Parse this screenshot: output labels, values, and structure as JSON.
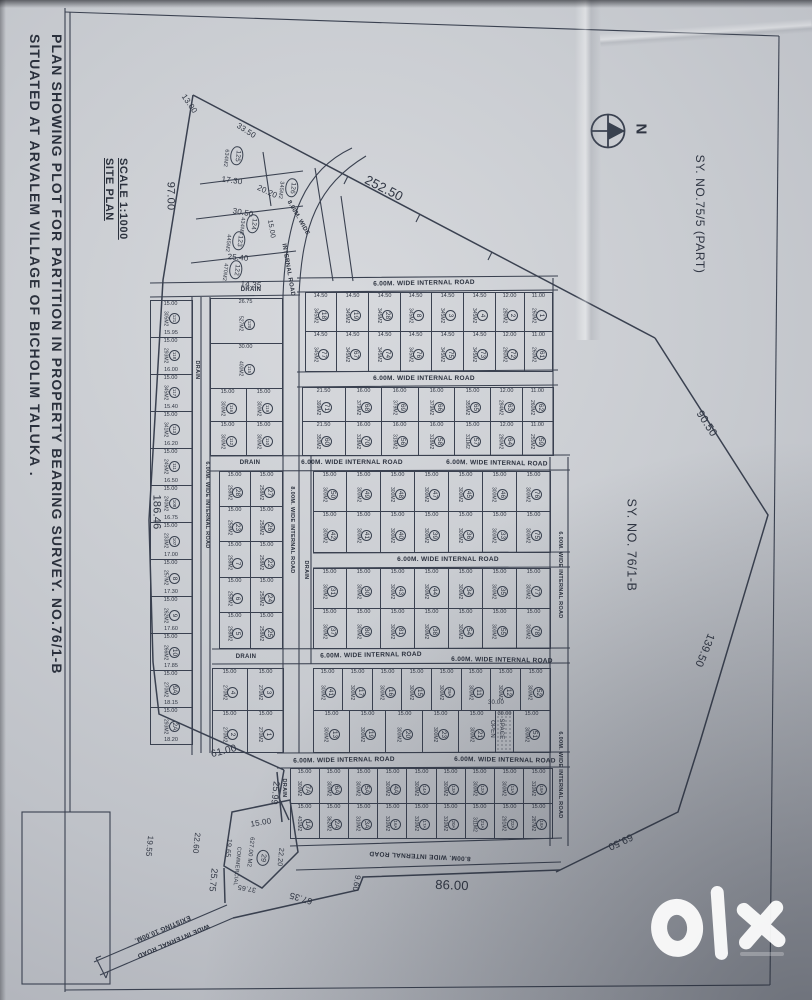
{
  "header": {
    "title_line1": "PLAN SHOWING PLOT FOR PARTITION IN PROPERTY BEARING SURVEY. NO.76/1-B",
    "title_line2": "SITUATED AT ARVALEM VILLAGE OF BICHOLIM TALUKA ."
  },
  "site_plan": {
    "label": "SITE PLAN",
    "scale": "SCALE 1:1000"
  },
  "survey": {
    "part_75": "SY. NO.75/5 (PART)",
    "main_76": "SY. NO. 76/1-B"
  },
  "compass": {
    "north": "N"
  },
  "watermark": {
    "brand": "olx"
  },
  "ink_color": "#323947",
  "paper_color": "#c9ccd1",
  "boundary_dimensions": [
    {
      "t": "97.00",
      "x": 170,
      "y": 196,
      "r": 90,
      "s": 11
    },
    {
      "t": "252.50",
      "x": 384,
      "y": 188,
      "r": 27,
      "s": 13
    },
    {
      "t": "90.50",
      "x": 706,
      "y": 424,
      "r": 57,
      "s": 11
    },
    {
      "t": "139.50",
      "x": 704,
      "y": 650,
      "r": 112,
      "s": 11
    },
    {
      "t": "69.50",
      "x": 620,
      "y": 841,
      "r": 155,
      "s": 10
    },
    {
      "t": "86.00",
      "x": 452,
      "y": 885,
      "r": 2,
      "s": 13
    },
    {
      "t": "67.35",
      "x": 301,
      "y": 898,
      "r": 197,
      "s": 9
    },
    {
      "t": "9.60",
      "x": 356,
      "y": 883,
      "r": 100,
      "s": 8
    },
    {
      "t": "186.46",
      "x": 156,
      "y": 512,
      "r": 90,
      "s": 11
    },
    {
      "t": "61.00",
      "x": 224,
      "y": 752,
      "r": -14,
      "s": 10
    },
    {
      "t": "25.99",
      "x": 275,
      "y": 793,
      "r": 96,
      "s": 9
    },
    {
      "t": "25.75",
      "x": 213,
      "y": 880,
      "r": 96,
      "s": 9
    },
    {
      "t": "19.55",
      "x": 149,
      "y": 846,
      "r": 96,
      "s": 8
    },
    {
      "t": "22.60",
      "x": 196,
      "y": 843,
      "r": 96,
      "s": 8
    },
    {
      "t": "13.00",
      "x": 189,
      "y": 104,
      "r": 55,
      "s": 8
    },
    {
      "t": "33.50",
      "x": 246,
      "y": 131,
      "r": 33,
      "s": 8
    },
    {
      "t": "17.30",
      "x": 232,
      "y": 181,
      "r": 8,
      "s": 8
    },
    {
      "t": "30.50",
      "x": 243,
      "y": 213,
      "r": 10,
      "s": 8
    },
    {
      "t": "20.20",
      "x": 267,
      "y": 192,
      "r": 25,
      "s": 8
    },
    {
      "t": "25.40",
      "x": 238,
      "y": 258,
      "r": 5,
      "s": 8
    },
    {
      "t": "14.35",
      "x": 251,
      "y": 285,
      "r": 5,
      "s": 8
    },
    {
      "t": "15.00",
      "x": 271,
      "y": 229,
      "r": 80,
      "s": 7
    },
    {
      "t": "15.00",
      "x": 261,
      "y": 823,
      "r": -10,
      "s": 8
    },
    {
      "t": "19.65",
      "x": 228,
      "y": 848,
      "r": 96,
      "s": 7
    },
    {
      "t": "22.20",
      "x": 280,
      "y": 857,
      "r": 96,
      "s": 7
    },
    {
      "t": "37.65",
      "x": 247,
      "y": 888,
      "r": 190,
      "s": 7
    },
    {
      "t": "30.00",
      "x": 496,
      "y": 703,
      "r": 0,
      "s": 6
    },
    {
      "t": "627.00 M2",
      "x": 250,
      "y": 852,
      "r": 96,
      "s": 6
    },
    {
      "t": "COMMERCIAL",
      "x": 236,
      "y": 866,
      "r": 96,
      "s": 5.5
    },
    {
      "t": "29",
      "x": 263,
      "y": 858,
      "r": 96,
      "s": 7,
      "c": 1
    },
    {
      "t": "OPEN",
      "x": 492,
      "y": 729,
      "r": 90,
      "s": 6
    },
    {
      "t": "SPACE",
      "x": 501,
      "y": 729,
      "r": 90,
      "s": 6
    }
  ],
  "road_labels": [
    {
      "t": "6.00M. WIDE INTERNAL ROAD",
      "x": 424,
      "y": 284,
      "r": -1,
      "s": 6.5
    },
    {
      "t": "6.00M. WIDE INTERNAL ROAD",
      "x": 424,
      "y": 379,
      "r": 0,
      "s": 6.5
    },
    {
      "t": "6.00M. WIDE INTERNAL ROAD",
      "x": 352,
      "y": 463,
      "r": 0,
      "s": 6.5
    },
    {
      "t": "6.00M. WIDE INTERNAL ROAD",
      "x": 497,
      "y": 464,
      "r": 1,
      "s": 6.5
    },
    {
      "t": "6.00M. WIDE INTERNAL ROAD",
      "x": 448,
      "y": 560,
      "r": 0,
      "s": 6.5
    },
    {
      "t": "6.00M. WIDE INTERNAL ROAD",
      "x": 371,
      "y": 656,
      "r": -1,
      "s": 6.5
    },
    {
      "t": "6.00M. WIDE INTERNAL ROAD",
      "x": 502,
      "y": 661,
      "r": 1,
      "s": 6.5
    },
    {
      "t": "6.00M. WIDE INTERNAL ROAD",
      "x": 344,
      "y": 761,
      "r": -1,
      "s": 6.5
    },
    {
      "t": "6.00M. WIDE INTERNAL ROAD",
      "x": 505,
      "y": 761,
      "r": 1,
      "s": 6.5
    },
    {
      "t": "8.00M. WIDE INTERNAL ROAD",
      "x": 420,
      "y": 855,
      "r": 183,
      "s": 6.5
    },
    {
      "t": "DRAIN",
      "x": 251,
      "y": 290,
      "r": 0,
      "s": 6
    },
    {
      "t": "DRAIN",
      "x": 250,
      "y": 463,
      "r": 0,
      "s": 6
    },
    {
      "t": "DRAIN",
      "x": 246,
      "y": 657,
      "r": 0,
      "s": 6
    },
    {
      "t": "DRAIN",
      "x": 196,
      "y": 370,
      "r": 90,
      "s": 5.5
    },
    {
      "t": "6.00M. WIDE INTERNAL ROAD",
      "x": 206,
      "y": 505,
      "r": 90,
      "s": 5.5
    },
    {
      "t": "8.00M. WIDE INTERNAL ROAD",
      "x": 291,
      "y": 530,
      "r": 90,
      "s": 5.5
    },
    {
      "t": "DRAIN",
      "x": 305,
      "y": 570,
      "r": 90,
      "s": 5.5
    },
    {
      "t": "DRAIN",
      "x": 283,
      "y": 788,
      "r": 90,
      "s": 5.5
    },
    {
      "t": "6.00M. WIDE INTERNAL ROAD",
      "x": 559,
      "y": 575,
      "r": 90,
      "s": 5.5
    },
    {
      "t": "6.00M. WIDE INTERNAL ROAD",
      "x": 559,
      "y": 775,
      "r": 90,
      "s": 5.5
    },
    {
      "t": "8.00M. WIDE",
      "x": 298,
      "y": 218,
      "r": 60,
      "s": 6
    },
    {
      "t": "INTERNAL ROAD",
      "x": 288,
      "y": 270,
      "r": 80,
      "s": 6
    },
    {
      "t": "EXISTING 10.00M.",
      "x": 162,
      "y": 928,
      "r": 157,
      "s": 6.5
    },
    {
      "t": "WIDE INTERNAL ROAD",
      "x": 173,
      "y": 940,
      "r": 157,
      "s": 6.5
    }
  ],
  "triangle_plots": [
    {
      "n": "125",
      "a": "634M2",
      "x": 237,
      "y": 156
    },
    {
      "n": "126",
      "a": "345M2",
      "x": 292,
      "y": 188
    },
    {
      "n": "124",
      "a": "434M2",
      "x": 253,
      "y": 224
    },
    {
      "n": "123",
      "a": "445M2",
      "x": 239,
      "y": 241
    },
    {
      "n": "122",
      "a": "470M2",
      "x": 236,
      "y": 270
    }
  ],
  "blocks": [
    {
      "x": 150,
      "y": 300,
      "w": 42,
      "h": 445,
      "wd": "15.00",
      "rows": [
        [
          {
            "n": "121",
            "a": "305M2",
            "d": "15.95"
          }
        ],
        [
          {
            "n": "118",
            "a": "293M2",
            "d": "16.00"
          }
        ],
        [
          {
            "n": "117",
            "a": "345M2",
            "d": "15.40"
          }
        ],
        [
          {
            "n": "113",
            "a": "341M2",
            "d": "16.20"
          }
        ],
        [
          {
            "n": "111",
            "a": "245M2",
            "d": "16.50"
          }
        ],
        [
          {
            "n": "108",
            "a": "240M2",
            "d": "16.75"
          }
        ],
        [
          {
            "n": "107",
            "a": "233M2",
            "d": "17.00"
          }
        ],
        [
          {
            "n": "8",
            "a": "257M2",
            "d": "17.30"
          }
        ],
        [
          {
            "n": "9",
            "a": "262M2",
            "d": "17.60"
          }
        ],
        [
          {
            "n": "10",
            "a": "266M2",
            "d": "17.85"
          }
        ],
        [
          {
            "n": "9A",
            "a": "270M2",
            "d": "18.15"
          }
        ],
        [
          {
            "n": "2A",
            "a": "293M2",
            "d": "18.20"
          }
        ]
      ]
    },
    {
      "x": 210,
      "y": 298,
      "w": 72,
      "h": 90,
      "rows": [
        [
          {
            "n": "120",
            "a": "527M2",
            "w": "26.75"
          }
        ],
        [
          {
            "n": "115",
            "a": "400M2",
            "w": "30.00"
          }
        ]
      ]
    },
    {
      "x": 210,
      "y": 388,
      "w": 72,
      "h": 67,
      "wd": "15.00",
      "a": "300M2",
      "rows": [
        [
          {
            "n": "116"
          },
          {
            "n": "119"
          }
        ],
        [
          {
            "n": "112"
          },
          {
            "n": "110"
          }
        ]
      ]
    },
    {
      "x": 219,
      "y": 471,
      "w": 63,
      "h": 177,
      "wd": "15.00",
      "a": "258M2",
      "rows": [
        [
          {
            "n": "28"
          },
          {
            "n": "27"
          }
        ],
        [
          {
            "n": "23"
          },
          {
            "n": "26"
          }
        ],
        [
          {
            "n": "7"
          },
          {
            "n": "22"
          }
        ],
        [
          {
            "n": "6"
          },
          {
            "n": "24"
          }
        ],
        [
          {
            "n": "5"
          },
          {
            "n": "25"
          }
        ]
      ]
    },
    {
      "x": 212,
      "y": 668,
      "w": 71,
      "h": 84,
      "wd": "15.00",
      "a": "270M2",
      "rows": [
        [
          {
            "n": "4"
          },
          {
            "n": "3"
          }
        ],
        [
          {
            "n": "2"
          },
          {
            "n": "1"
          }
        ]
      ]
    },
    {
      "x": 305,
      "y": 292,
      "w": 248,
      "h": 79,
      "wd": "14.50",
      "a": "345M2",
      "rows": [
        [
          {
            "n": "18"
          },
          {
            "n": "19"
          },
          {
            "n": "28"
          },
          {
            "n": "8"
          },
          {
            "n": "3"
          },
          {
            "n": "4"
          },
          {
            "n": "2",
            "w": "12.00",
            "a": "280M2"
          },
          {
            "n": "1",
            "w": "11.00",
            "a": "260M2"
          }
        ],
        [
          {
            "n": "77"
          },
          {
            "n": "67"
          },
          {
            "n": "74"
          },
          {
            "n": "76"
          },
          {
            "n": "75"
          },
          {
            "n": "73"
          },
          {
            "n": "72",
            "w": "12.00",
            "a": "280M2"
          },
          {
            "n": "61",
            "w": "11.00",
            "a": "260M2"
          }
        ]
      ]
    },
    {
      "x": 302,
      "y": 387,
      "w": 251,
      "h": 68,
      "wd": "16.00",
      "a": "379M2",
      "rows": [
        [
          {
            "n": "71",
            "w": "21.50",
            "a": "399M2"
          },
          {
            "n": "68"
          },
          {
            "n": "69"
          },
          {
            "n": "66"
          },
          {
            "n": "65",
            "w": "15.00",
            "a": "355M2"
          },
          {
            "n": "63",
            "w": "12.00",
            "a": "284M2"
          },
          {
            "n": "62",
            "w": "11.00",
            "a": "260M2"
          }
        ],
        [
          {
            "n": "60",
            "w": "21.50",
            "a": "350M2"
          },
          {
            "n": "70",
            "a": "318M2"
          },
          {
            "n": "56",
            "a": "318M2"
          },
          {
            "n": "58",
            "a": "318M2"
          },
          {
            "n": "57",
            "w": "15.00",
            "a": "311M2"
          },
          {
            "n": "64",
            "w": "12.00",
            "a": "280M2"
          },
          {
            "n": "59",
            "w": "11.00",
            "a": "255M2"
          }
        ]
      ]
    },
    {
      "x": 313,
      "y": 471,
      "w": 237,
      "h": 81,
      "wd": "15.00",
      "a": "300M2",
      "rows": [
        [
          {
            "n": "50"
          },
          {
            "n": "49"
          },
          {
            "n": "48"
          },
          {
            "n": "47"
          },
          {
            "n": "45"
          },
          {
            "n": "46"
          },
          {
            "n": "76"
          }
        ],
        [
          {
            "n": "42"
          },
          {
            "n": "41"
          },
          {
            "n": "40"
          },
          {
            "n": "39"
          },
          {
            "n": "36"
          },
          {
            "n": "33"
          },
          {
            "n": "75"
          }
        ]
      ]
    },
    {
      "x": 313,
      "y": 568,
      "w": 237,
      "h": 80,
      "wd": "15.00",
      "a": "300M2",
      "rows": [
        [
          {
            "n": "31"
          },
          {
            "n": "30"
          },
          {
            "n": "43"
          },
          {
            "n": "44"
          },
          {
            "n": "34"
          },
          {
            "n": "35"
          },
          {
            "n": "77"
          }
        ],
        [
          {
            "n": "37"
          },
          {
            "n": "80"
          },
          {
            "n": "81"
          },
          {
            "n": "38"
          },
          {
            "n": "54"
          },
          {
            "n": "55"
          },
          {
            "n": "78"
          }
        ]
      ]
    },
    {
      "x": 313,
      "y": 668,
      "w": 237,
      "h": 84,
      "wd": "15.00",
      "a": "300M2",
      "rows": [
        [
          {
            "n": "41"
          },
          {
            "n": "17"
          },
          {
            "n": "16"
          },
          {
            "n": "15"
          },
          {
            "n": "29A"
          },
          {
            "n": "11"
          },
          {
            "n": "12"
          },
          {
            "n": "52"
          }
        ],
        [
          {
            "n": "13"
          },
          {
            "n": "19"
          },
          {
            "n": "20"
          },
          {
            "n": "23"
          },
          {
            "n": "21"
          },
          {
            "open": true,
            "f": 2,
            "w": "30.00"
          },
          {
            "n": "51"
          }
        ]
      ]
    },
    {
      "x": 290,
      "y": 768,
      "w": 263,
      "h": 70,
      "wd": "15.00",
      "a": "300M2",
      "rows": [
        [
          {
            "n": "7A"
          },
          {
            "n": "6A"
          },
          {
            "n": "5A"
          },
          {
            "n": "4A"
          },
          {
            "n": "14A"
          },
          {
            "n": "13A"
          },
          {
            "n": "12A"
          },
          {
            "n": "11A"
          },
          {
            "n": "19A",
            "a": "310M2"
          }
        ],
        [
          {
            "n": "1A",
            "a": "431M2"
          },
          {
            "n": "2A",
            "a": "362M2"
          },
          {
            "n": "3A",
            "a": "310M2"
          },
          {
            "n": "16A",
            "a": "310M2"
          },
          {
            "n": "17A",
            "a": "310M2"
          },
          {
            "n": "20A",
            "a": "310M2"
          },
          {
            "n": "21A",
            "a": "311M2"
          },
          {
            "n": "22A",
            "a": "291M2"
          },
          {
            "n": "18A",
            "a": "287M2"
          }
        ]
      ]
    }
  ]
}
